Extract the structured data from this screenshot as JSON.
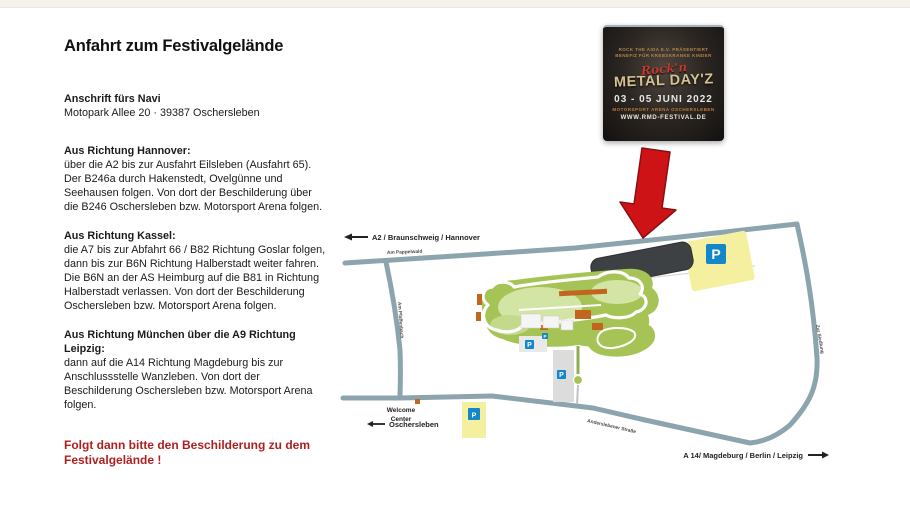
{
  "article": {
    "title": "Anfahrt zum Festivalgelände",
    "address": {
      "heading": "Anschrift fürs Navi",
      "line": "Motopark Allee 20 · 39387 Oschersleben"
    },
    "sections": [
      {
        "heading": "Aus Richtung Hannover:",
        "body": "über die A2 bis zur Ausfahrt Eilsleben (Ausfahrt 65). Der B246a durch Hakenstedt, Ovelgünne und Seehausen folgen. Von dort der Beschilderung über die B246 Oschersleben bzw. Motorsport Arena folgen."
      },
      {
        "heading": "Aus Richtung Kassel:",
        "body": "die A7 bis zur Abfahrt 66 / B82 Richtung Goslar folgen, dann bis zur B6N Richtung Halberstadt weiter fahren. Die B6N an der AS Heimburg auf die B81 in Richtung Halberstadt verlassen. Von dort der Beschilderung Oschersleben bzw. Motorsport Arena folgen."
      },
      {
        "heading": "Aus Richtung München über die A9 Richtung Leipzig:",
        "body": "dann auf die A14 Richtung Magdeburg bis zur Anschlussstelle Wanzleben. Von dort der Beschilderung Oschersleben bzw. Motorsport Arena folgen."
      }
    ],
    "note": "Folgt dann bitte den Beschilderung zu dem Festivalgelände !",
    "note_color": "#b01f1f"
  },
  "poster": {
    "pre_line1": "ROCK THE AIDA E.V. PRÄSENTIERT",
    "pre_line2": "BENEFIZ FÜR KREBSKRANKE KINDER",
    "script_word": "Rock'n",
    "title": "METAL DAY'Z",
    "date": "03 - 05 JUNI 2022",
    "venue": "MOTORSPORT ARENA OSCHERSLEBEN",
    "website": "WWW.RMD-FESTIVAL.DE"
  },
  "map": {
    "labels": {
      "a2": "A2 / Braunschweig / Hannover",
      "a14": "A 14/ Magdeburg / Berlin / Leipzig",
      "street_top": "Am Pappelwald",
      "street_left": "Am Pfaffenbach",
      "street_bottom": "Anderslebener Straße",
      "street_right": "Zur Siedlung",
      "welcome_center_line1": "Welcome",
      "welcome_center_line2": "Center",
      "oschersleben": "Oschersleben",
      "parking": "P"
    },
    "colors": {
      "road": "#8ca4ae",
      "parking_yellow": "#f4f0a0",
      "parking_blue": "#1287c9",
      "festival_area": "#3e4144",
      "track_green": "#a6c455",
      "arrow_red": "#ce1317"
    }
  }
}
